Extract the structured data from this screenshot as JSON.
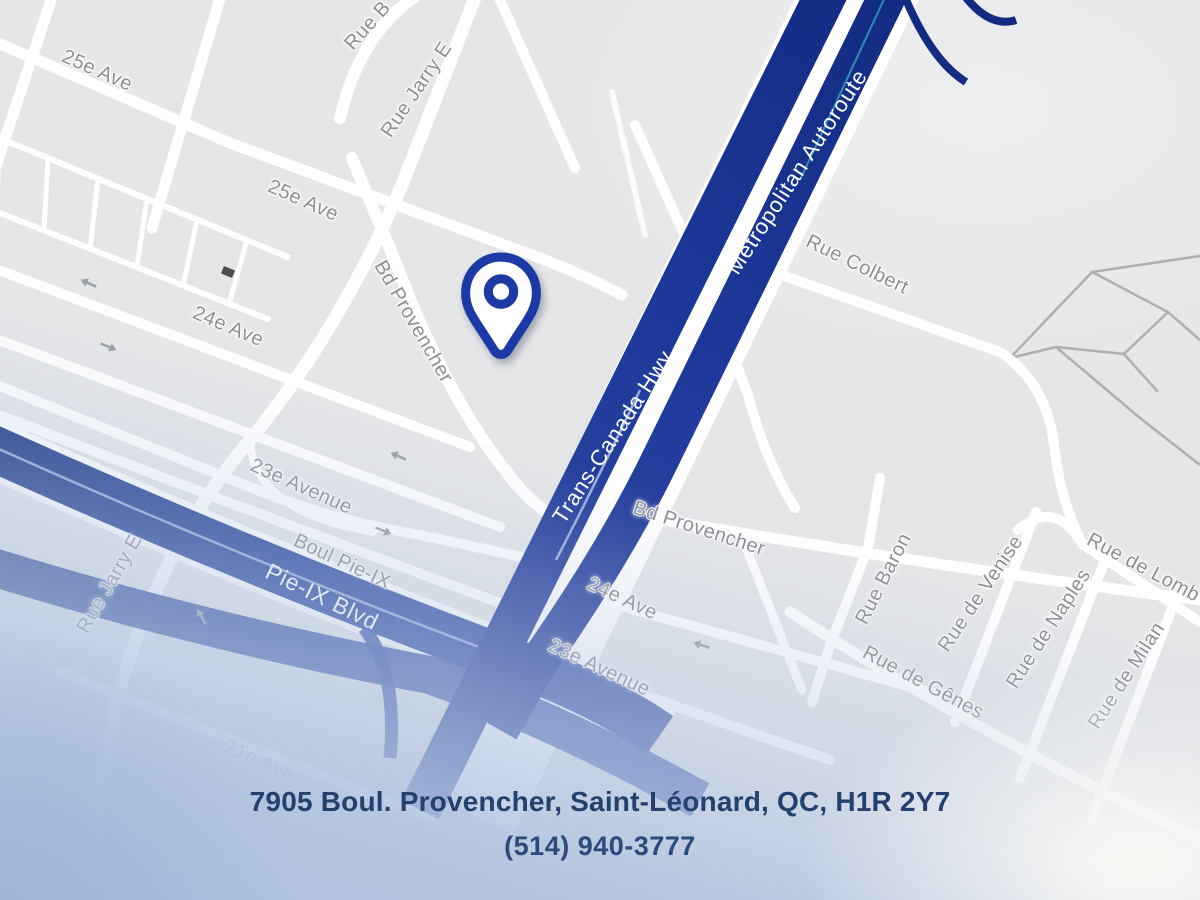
{
  "address_card": {
    "address": "7905 Boul. Provencher, Saint-Léonard, QC, H1R 2Y7",
    "phone": "(514) 940-3777"
  },
  "map": {
    "street_labels": [
      {
        "text": "25e Ave"
      },
      {
        "text": "25e Ave"
      },
      {
        "text": "Rue Jarry E"
      },
      {
        "text": "Rue B"
      },
      {
        "text": "Bd Provencher"
      },
      {
        "text": "24e Ave"
      },
      {
        "text": "Rue Colbert"
      },
      {
        "text": "23e Avenue"
      },
      {
        "text": "Boul Pie-IX"
      },
      {
        "text": "Rue Jarry E"
      },
      {
        "text": "Bd Provencher"
      },
      {
        "text": "24e Ave"
      },
      {
        "text": "23e Avenue"
      },
      {
        "text": "Rue Baron"
      },
      {
        "text": "Rue de Venise"
      },
      {
        "text": "Rue de Naples"
      },
      {
        "text": "Rue de Milan"
      },
      {
        "text": "Rue de Gênes"
      },
      {
        "text": "Rue de Lomb"
      },
      {
        "text": "21e Ave"
      }
    ],
    "highway_labels": [
      {
        "text": "Metropolitan Autoroute"
      },
      {
        "text": "Trans-Canada Hwy"
      },
      {
        "text": "Pie-IX Blvd"
      }
    ],
    "colors": {
      "highway": "#1d3a9b",
      "pin": "#1c3aa6",
      "background": "#e5e6e8",
      "road": "#ffffff",
      "street_label": "#8b8e92",
      "address_text": "#24406f"
    }
  }
}
